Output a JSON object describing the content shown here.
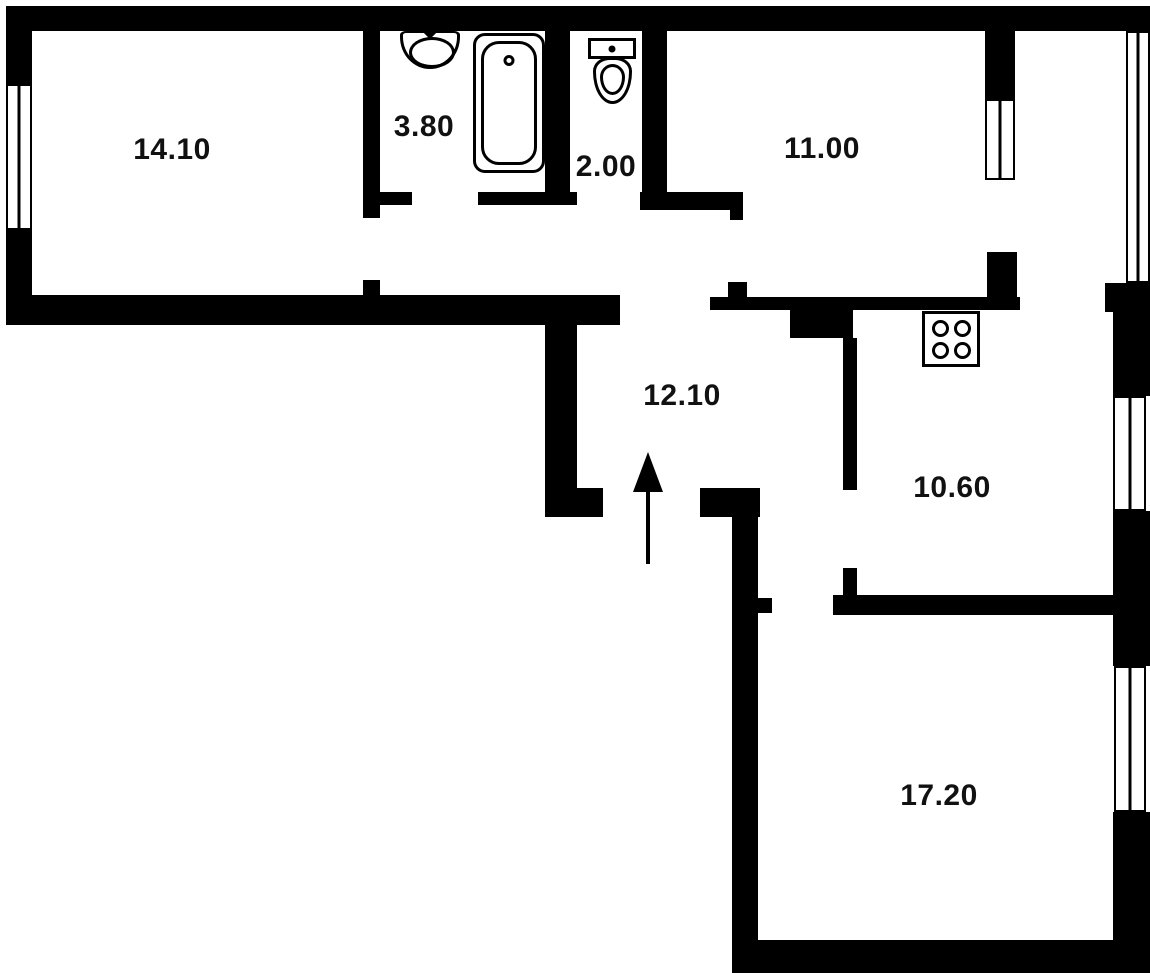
{
  "floorplan": {
    "type": "apartment-floor-plan",
    "colors": {
      "background": "#ffffff",
      "walls": "#000000",
      "labels": "#111111"
    },
    "room_labels": {
      "room_1410": "14.10",
      "bathroom": "3.80",
      "wc": "2.00",
      "room_1100": "11.00",
      "hallway": "12.10",
      "kitchen": "10.60",
      "room_1720": "17.20"
    },
    "fixtures": {
      "bathroom": [
        "sink",
        "bathtub"
      ],
      "wc": [
        "toilet"
      ],
      "kitchen": [
        "stove"
      ],
      "hallway": [
        "entrance-arrow"
      ]
    },
    "window_count": 5
  }
}
